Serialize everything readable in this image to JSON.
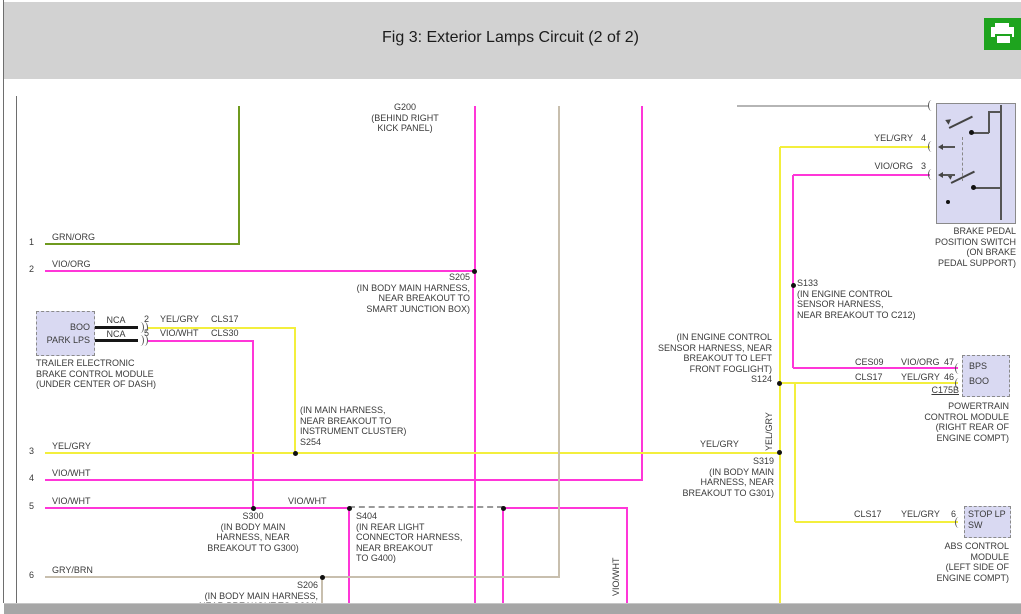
{
  "colors": {
    "header_bg": "#d2d2d2",
    "bar": "#a6a6a6",
    "print_green": "#1ea41e",
    "wire_yellow": "#f3ef3d",
    "wire_magenta": "#ff36d8",
    "wire_green": "#6f9a1f",
    "wire_tan": "#c8bfae",
    "wire_gray": "#b5b5b5",
    "box_fill": "#d9d9f2",
    "text": "#3a3a3a"
  },
  "texts": {
    "title": "Fig 3: Exterior Lamps Circuit (2 of 2)",
    "g200": "G200\n(BEHIND RIGHT\nKICK PANEL)",
    "s205": "S205\n(IN BODY MAIN HARNESS,\nNEAR BREAKOUT TO\nSMART JUNCTION BOX)",
    "s254": "(IN MAIN HARNESS,\nNEAR BREAKOUT TO\nINSTRUMENT CLUSTER)\nS254",
    "s300": "S300\n(IN BODY MAIN\nHARNESS, NEAR\nBREAKOUT TO G300)",
    "s404": "S404\n(IN REAR LIGHT\nCONNECTOR HARNESS,\nNEAR BREAKOUT\nTO G400)",
    "s206": "S206\n(IN BODY MAIN HARNESS,\nNEAR BREAKOUT TO G301)",
    "s133": "S133\n(IN ENGINE CONTROL\nSENSOR HARNESS,\nNEAR BREAKOUT TO C212)",
    "s124": "(IN ENGINE CONTROL\nSENSOR HARNESS, NEAR\nBREAKOUT TO LEFT\nFRONT FOGLIGHT)\nS124",
    "s319": "S319\n(IN BODY MAIN\nHARNESS, NEAR\nBREAKOUT TO G301)",
    "wire1_num": "1",
    "wire1_color": "GRN/ORG",
    "wire2_num": "2",
    "wire2_color": "VIO/ORG",
    "wire3_num": "3",
    "wire3_color": "YEL/GRY",
    "wire4_num": "4",
    "wire4_color": "VIO/WHT",
    "wire5_num": "5",
    "wire5_color": "VIO/WHT",
    "wire6_num": "6",
    "wire6_color": "GRY/BRN",
    "wire3_mid_color": "YEL/GRY",
    "wire5_mid_color": "VIO/WHT",
    "vert_yelgry": "YEL/GRY",
    "vert_viowht": "VIO/WHT",
    "tebcm_pin_boo": "BOO",
    "tebcm_pin_park": "PARK LPS",
    "nca_1": "NCA",
    "nca_2": "NCA",
    "pin2_num": "2",
    "pin2_color": "YEL/GRY",
    "pin2_circuit": "CLS17",
    "pin5_num": "5",
    "pin5_color": "VIO/WHT",
    "pin5_circuit": "CLS30",
    "tebcm_label": "TRAILER ELECTRONIC\nBRAKE CONTROL MODULE\n(UNDER CENTER OF DASH)",
    "sw_pin4_color": "YEL/GRY",
    "sw_pin4_num": "4",
    "sw_pin3_color": "VIO/ORG",
    "sw_pin3_num": "3",
    "brake_switch_label": "BRAKE PEDAL\nPOSITION SWITCH\n(ON BRAKE\nPEDAL SUPPORT)",
    "pcm_row1_circuit": "CES09",
    "pcm_row1_color": "VIO/ORG",
    "pcm_row1_pin": "47",
    "pcm_row2_circuit": "CLS17",
    "pcm_row2_color": "YEL/GRY",
    "pcm_row2_pin": "46",
    "pcm_conn": "C175B",
    "pcm_pin_bps": "BPS",
    "pcm_pin_boo": "BOO",
    "pcm_label": "POWERTRAIN\nCONTROL MODULE\n(RIGHT REAR OF\nENGINE COMPT)",
    "abs_row_circuit": "CLS17",
    "abs_row_color": "YEL/GRY",
    "abs_row_pin": "6",
    "abs_pin": "STOP LP\nSW",
    "abs_label": "ABS CONTROL\nMODULE\n(LEFT SIDE OF\nENGINE COMPT)"
  }
}
